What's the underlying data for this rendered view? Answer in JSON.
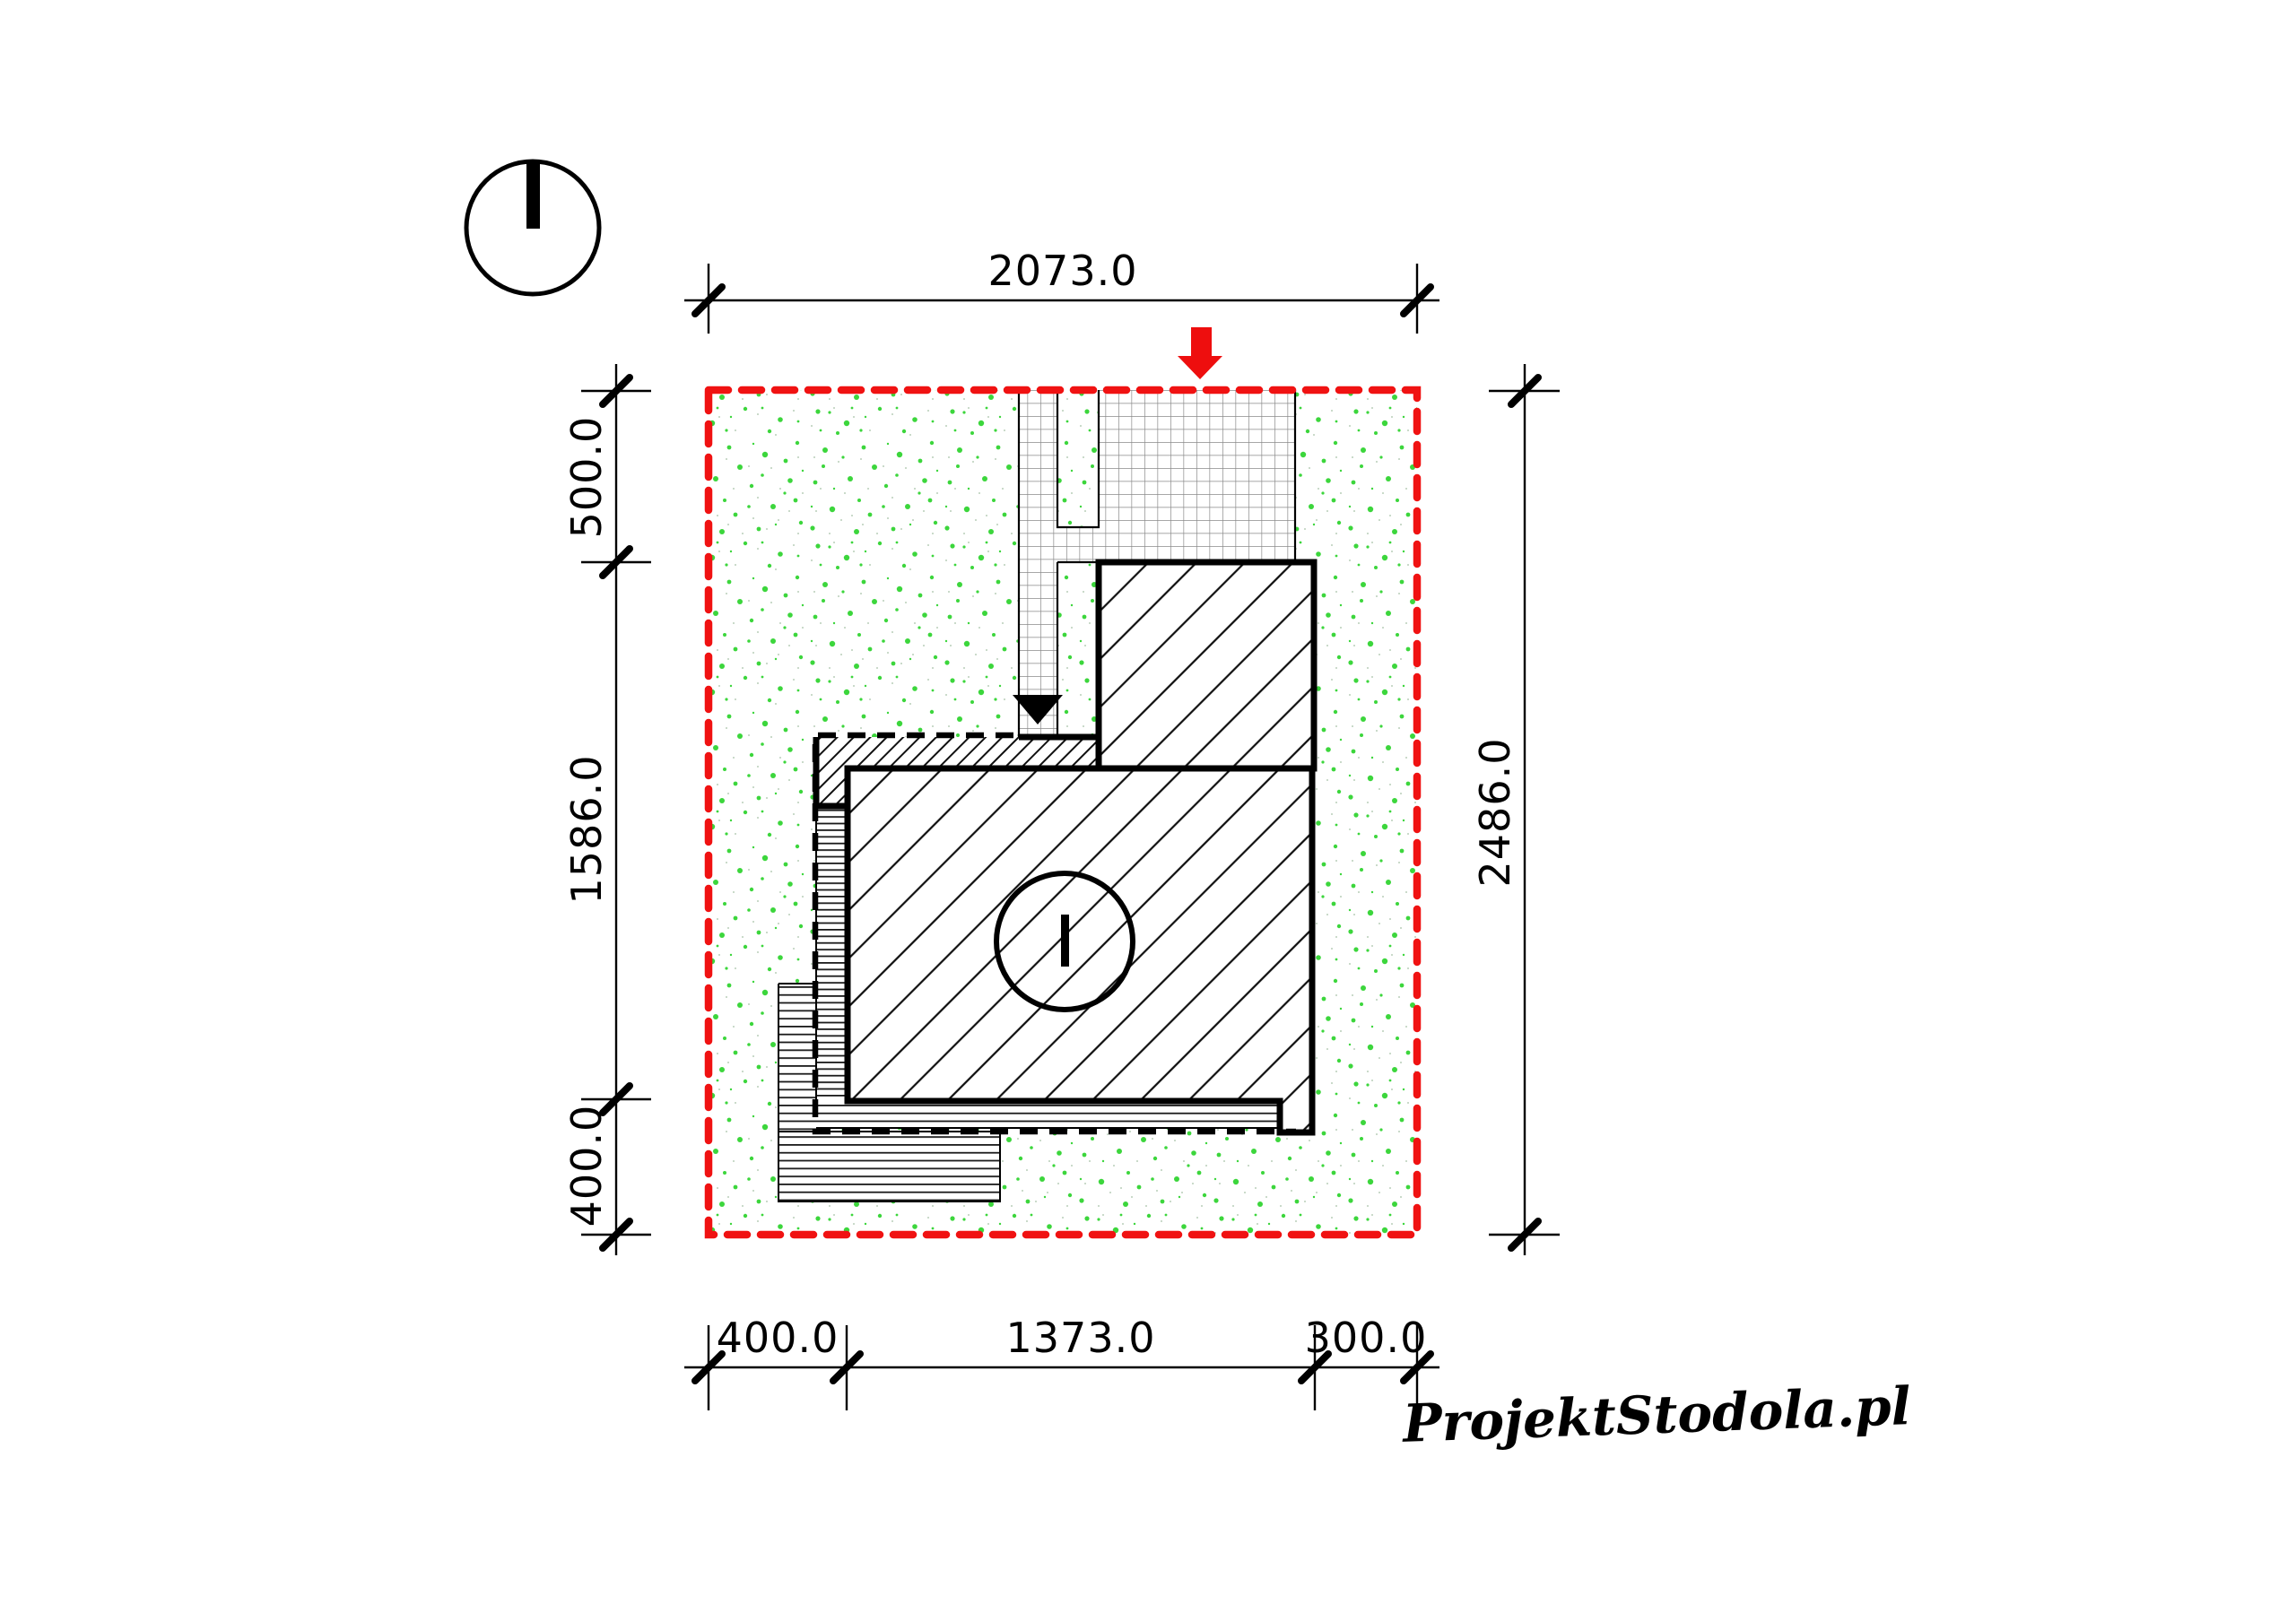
{
  "drawing": {
    "type": "architectural-site-plan",
    "dimensions": {
      "top": {
        "label": "2073.0"
      },
      "right": {
        "label": "2486.0"
      },
      "left": {
        "segments": [
          "500.0",
          "1586.0",
          "400.0"
        ]
      },
      "bottom": {
        "segments": [
          "400.0",
          "1373.0",
          "300.0"
        ]
      }
    },
    "watermark": {
      "text": "ProjektStodola.pl"
    },
    "colors": {
      "boundary_red": "#f01212",
      "arrow_red": "#ee0e0e",
      "lawn_green": "#3cd63c",
      "speckle_faint": "#b9cfb9",
      "grid_gray": "#8a8a8a",
      "ink": "#000000"
    }
  }
}
